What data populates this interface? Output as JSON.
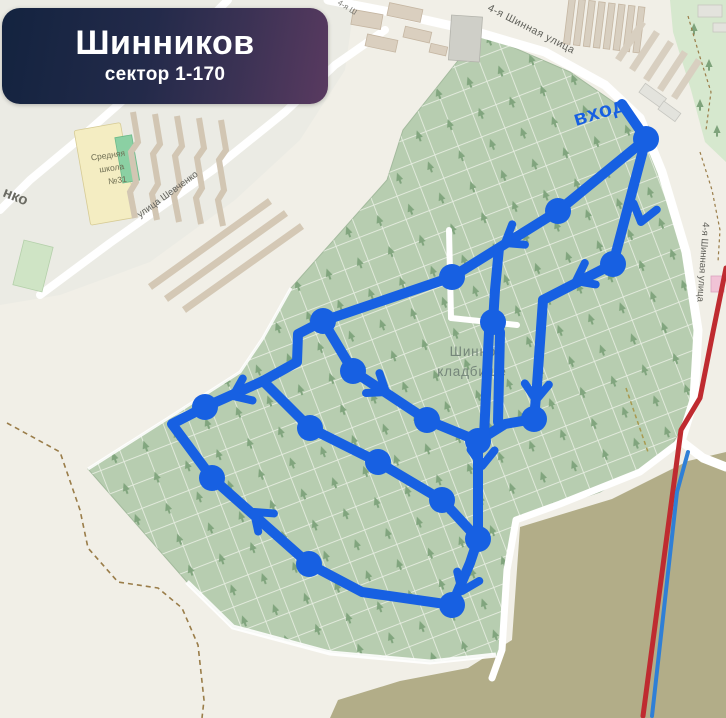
{
  "banner": {
    "title": "Шинников",
    "subtitle": "сектор 1-170"
  },
  "labels": {
    "entrance": "вход",
    "cemetery": [
      "Шинное",
      "кладбище"
    ],
    "school": [
      "Средняя",
      "школа",
      "№31"
    ],
    "street_top": "4-я Шинная улица",
    "street_right": "4-я Шинная улица",
    "street_shevchenko": "улица Шевченко",
    "street_end_fragment": "нко",
    "street_top_fragment": "4-я Ш"
  },
  "colors": {
    "route": "#1760e2",
    "banner_start": "#13233f",
    "banner_end": "#593a60",
    "cemetery_green": "#b7cdb0",
    "khaki_field": "#b2ad88",
    "park_green": "#d6e8ce",
    "red_transit": "#bf2b30",
    "blue_transit": "#2f7fd6"
  },
  "route": {
    "stroke_width": 10,
    "node_radius": 13,
    "segments": [
      [
        [
          622,
          104
        ],
        [
          646,
          139
        ]
      ],
      [
        [
          646,
          139
        ],
        [
          558,
          211
        ],
        [
          452,
          277
        ],
        [
          323,
          321
        ]
      ],
      [
        [
          646,
          139
        ],
        [
          613,
          264
        ]
      ],
      [
        [
          613,
          264
        ],
        [
          543,
          300
        ],
        [
          537,
          385
        ],
        [
          534,
          419
        ]
      ],
      [
        [
          534,
          419
        ],
        [
          505,
          424
        ],
        [
          478,
          441
        ]
      ],
      [
        [
          323,
          321
        ],
        [
          298,
          334
        ],
        [
          297,
          362
        ],
        [
          263,
          381
        ]
      ],
      [
        [
          263,
          381
        ],
        [
          205,
          407
        ],
        [
          172,
          424
        ],
        [
          212,
          478
        ]
      ],
      [
        [
          212,
          478
        ],
        [
          309,
          564
        ],
        [
          362,
          592
        ],
        [
          452,
          605
        ]
      ],
      [
        [
          452,
          605
        ],
        [
          470,
          563
        ],
        [
          478,
          539
        ]
      ],
      [
        [
          478,
          539
        ],
        [
          478,
          441
        ]
      ],
      [
        [
          478,
          441
        ],
        [
          427,
          420
        ]
      ],
      [
        [
          427,
          420
        ],
        [
          353,
          371
        ],
        [
          323,
          321
        ]
      ],
      [
        [
          263,
          381
        ],
        [
          310,
          428
        ],
        [
          378,
          462
        ],
        [
          442,
          500
        ],
        [
          478,
          539
        ]
      ],
      [
        [
          499,
          248
        ],
        [
          495,
          290
        ],
        [
          493,
          322
        ]
      ],
      [
        [
          489,
          332
        ],
        [
          484,
          436
        ]
      ],
      [
        [
          500,
          332
        ],
        [
          498,
          422
        ]
      ]
    ],
    "nodes": [
      [
        646,
        139
      ],
      [
        558,
        211
      ],
      [
        613,
        264
      ],
      [
        452,
        277
      ],
      [
        323,
        321
      ],
      [
        353,
        371
      ],
      [
        493,
        322
      ],
      [
        534,
        419
      ],
      [
        427,
        420
      ],
      [
        478,
        441
      ],
      [
        205,
        407
      ],
      [
        212,
        478
      ],
      [
        310,
        428
      ],
      [
        378,
        462
      ],
      [
        442,
        500
      ],
      [
        478,
        539
      ],
      [
        309,
        564
      ],
      [
        452,
        605
      ]
    ],
    "arrows": [
      [
        641,
        222,
        105
      ],
      [
        505,
        243,
        148
      ],
      [
        576,
        281,
        153
      ],
      [
        536,
        400,
        93
      ],
      [
        482,
        466,
        92
      ],
      [
        462,
        591,
        113
      ],
      [
        254,
        512,
        -139
      ],
      [
        233,
        396,
        156
      ],
      [
        386,
        392,
        34
      ]
    ]
  },
  "transit_lines": [
    {
      "name": "red-transit-line",
      "color": "#bf2b30",
      "width": 5,
      "points": [
        [
          726,
          268
        ],
        [
          713,
          332
        ],
        [
          700,
          398
        ],
        [
          681,
          430
        ],
        [
          643,
          716
        ]
      ]
    },
    {
      "name": "blue-transit-line",
      "color": "#2f7fd6",
      "width": 4,
      "points": [
        [
          688,
          452
        ],
        [
          677,
          492
        ],
        [
          652,
          716
        ]
      ]
    }
  ]
}
